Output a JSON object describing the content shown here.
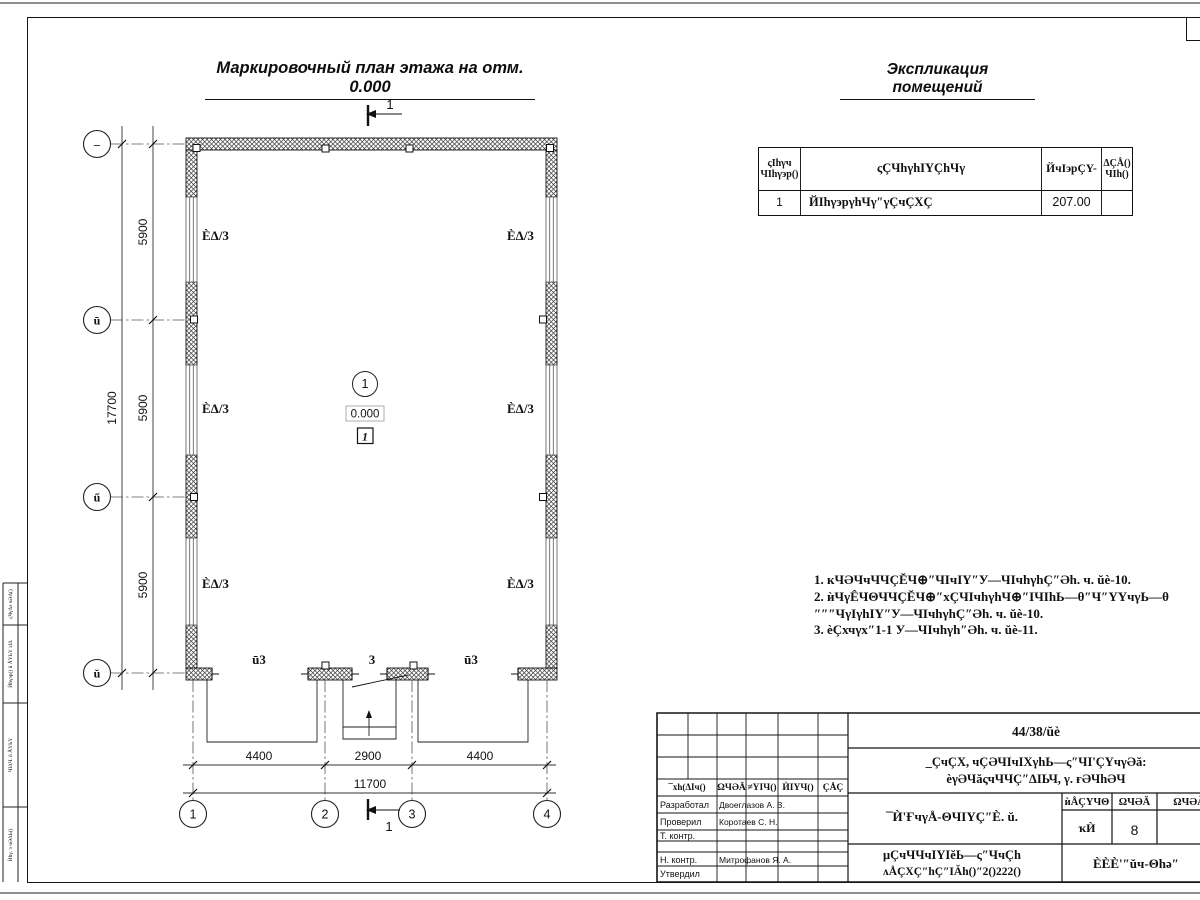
{
  "titles": {
    "plan": "Маркировочный план этажа на отм. 0.000",
    "explication": "Экспликация помещений"
  },
  "explication_table": {
    "headers": {
      "num_line1": "ςIhγч",
      "num_line2": "ЧIhγэр()",
      "name": "ςÇЧhγhIYÇhЧγ",
      "area": "ЙчIэрÇY-",
      "note_line1": "ΔÇÅ()",
      "note_line2": "ЧIh()"
    },
    "row": {
      "num": "1",
      "name": "ЙIhγэрγhЧγ″γÇчÇXÇ",
      "area": "207.00",
      "note": ""
    }
  },
  "notes": {
    "line1": "1. кЧӘЧчЧЧÇĔЧ⊕″ЧIчIY″У—ЧIчhγhÇ″Әh. ч. ŭè-10.",
    "line2": "2. ѝЧγÊЧΘЧЧÇĔЧ⊕″хÇЧIчhγhЧ⊕″IЧIhЬ—θ″Ч″YYчγЬ—θ",
    "line3": "″″″ЧγIγhIY″У—ЧIчhγhÇ″Әh. ч. ŭè-10.",
    "line4": "3. ѐÇхчγх″1-1 У—ЧIчhγh″Әh. ч. ŭè-11."
  },
  "plan": {
    "axes_letters": [
      "–",
      "ū",
      "ű",
      "ŭ"
    ],
    "axes_numbers": [
      "1",
      "2",
      "3",
      "4"
    ],
    "dims": {
      "v": [
        "5900",
        "5900",
        "5900"
      ],
      "v_total": "17700",
      "h": [
        "4400",
        "2900",
        "4400"
      ],
      "h_total": "11700"
    },
    "window_label": "ÈΔ/3",
    "gate_label": "ū3",
    "door_label": "3",
    "room_circle": "1",
    "elevation": "0.000",
    "room_box": "1",
    "section_mark": "1"
  },
  "strip": [
    "ςЧγΔэ чӘΔ()",
    "Ѝhγэр() ŭ ÅYЬY эIΔ",
    "ЧIΔЧ. ŭ ÅYЬY",
    "Ѝhγ. э чӘΔЬ()"
  ],
  "stamp": {
    "doc_number": "44/38/ŭè",
    "project_line1": "_ÇчÇX, чÇӘЧIчIXγhЬ—ς″ЧI'ÇYчγӘă:",
    "project_line2": "ѐγӘЧăςчЧЧÇ″ΔIЬЧ, γ. ғӘЧhӘЧ",
    "title": "¯Ѝ'ҒчγÅ-ΘЧIYÇ″È. ŭ.",
    "doc_line1": "μÇчЧЧчIYIĕЬ—ς″ЧчÇh",
    "doc_line2": "ʌÅÇXÇ″hÇ″IĂh()″2()222()",
    "org": "ÈÈÈ'″ŭч-Θhә″",
    "cols": [
      "¯хh(ΔIч()",
      "ΩЧӘĂ",
      "≠YIЧ()",
      "ЍIYЧ()",
      "ÇÅÇ"
    ],
    "sub": {
      "stage_h": "ѝÅÇYЧΘ",
      "sheet_h": "ΩЧӘĂ",
      "sheets_h": "ΩЧӘĂI",
      "stage": "ҡЍ",
      "sheet": "8"
    },
    "roles": {
      "dev": "Разработал",
      "check": "Проверил",
      "tcontr": "Т. контр.",
      "ncontr": "Н. контр.",
      "approve": "Утвердил"
    },
    "names": {
      "dev": "Двоеглазов А. В.",
      "check": "Коротаев С. Н.",
      "ncontr": "Митрофанов Я. А."
    }
  }
}
